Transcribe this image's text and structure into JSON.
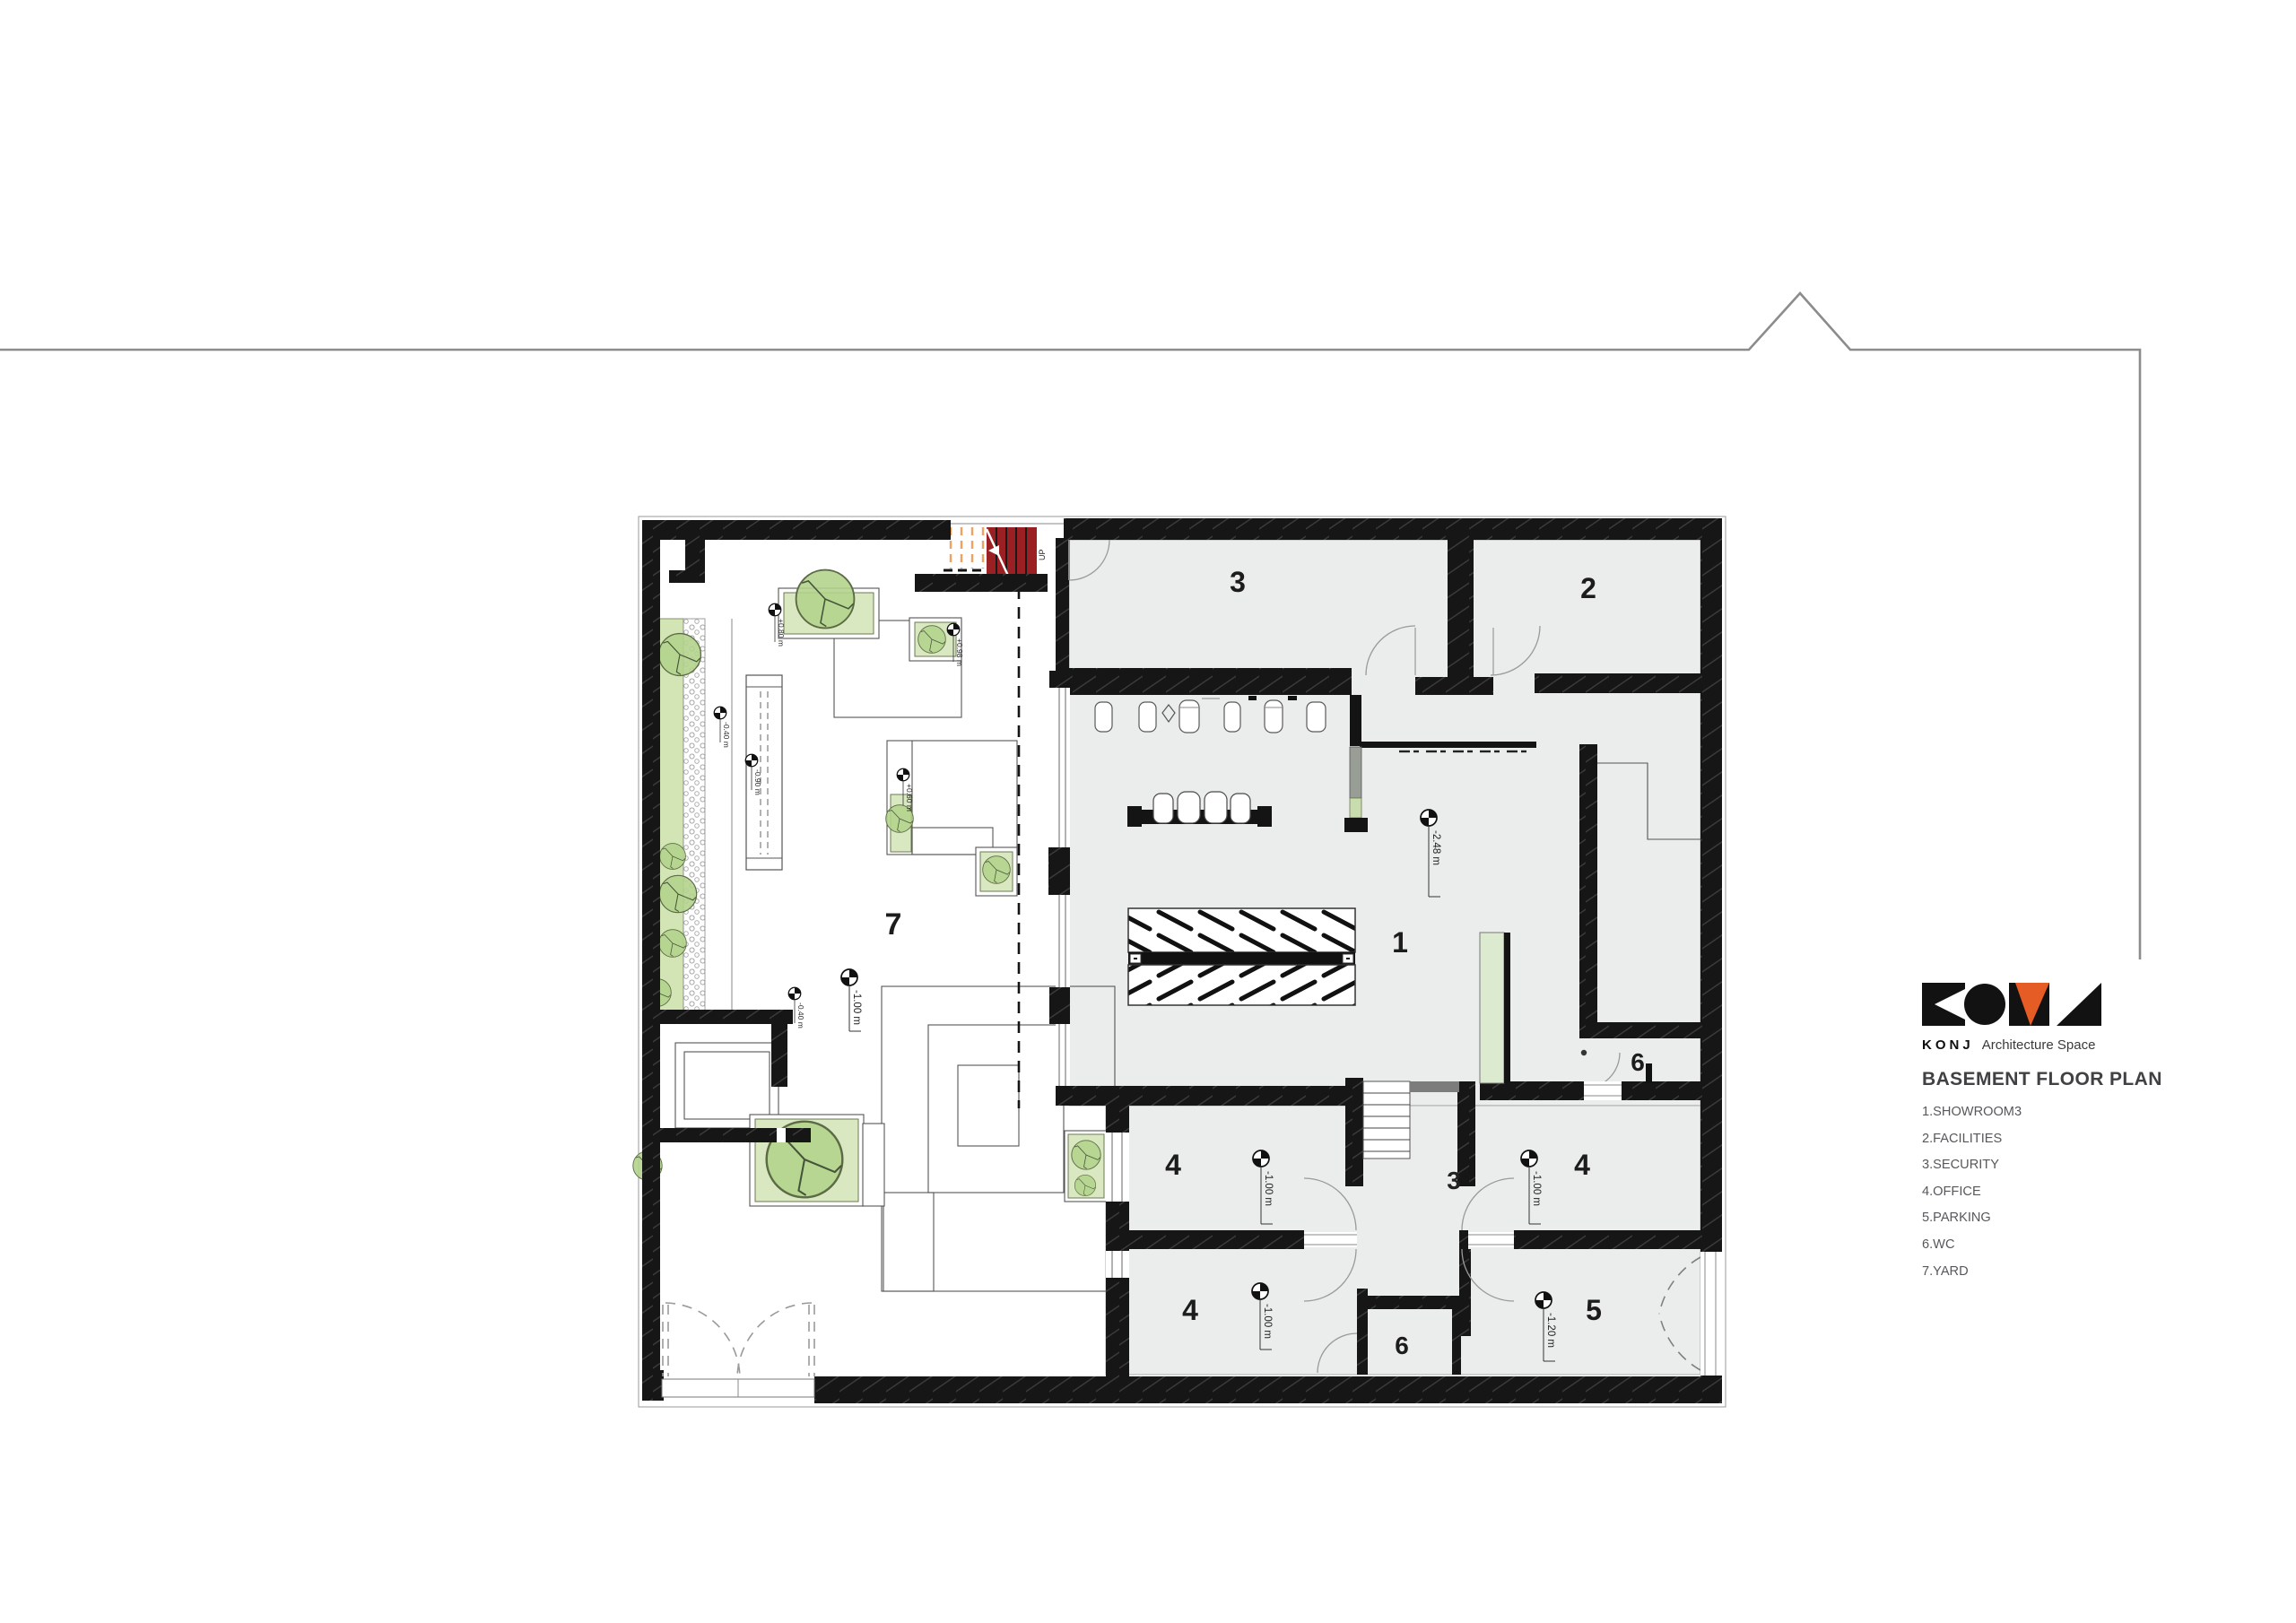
{
  "legend": {
    "brand_bold": "KONJ",
    "brand_rest": "Architecture Space",
    "title": "BASEMENT FLOOR PLAN",
    "items": [
      "1.SHOWROOM3",
      "2.FACILITIES",
      "3.SECURITY",
      "4.OFFICE",
      "5.PARKING",
      "6.WC",
      "7.YARD"
    ],
    "logo_colors": {
      "black": "#121212",
      "orange": "#e55c25"
    }
  },
  "plan": {
    "stair_up_label": "UP",
    "labels": [
      {
        "text": "3"
      },
      {
        "text": "2"
      },
      {
        "text": "1"
      },
      {
        "text": "4"
      },
      {
        "text": "4"
      },
      {
        "text": "4"
      },
      {
        "text": "5"
      },
      {
        "text": "6"
      },
      {
        "text": "6"
      },
      {
        "text": "7"
      },
      {
        "text": "3"
      }
    ],
    "elevation_markers": [
      {
        "value": "-2.48 m"
      },
      {
        "value": "-1.00 m"
      },
      {
        "value": "-1.00 m"
      },
      {
        "value": "-1.00 m"
      },
      {
        "value": "-1.20 m"
      },
      {
        "value": "-1.00 m"
      },
      {
        "value": "+0.80 m"
      },
      {
        "value": "+0.98 m"
      },
      {
        "value": "+0.60 m"
      },
      {
        "value": "-0.40 m"
      },
      {
        "value": "-0.90 m"
      },
      {
        "value": "-0.40 m"
      }
    ],
    "colors": {
      "wall": "#161616",
      "floor": "#ebecec",
      "stair_red": "#9b2024",
      "stair_orange_dash": "#eda262",
      "grass": "#d4e5b5",
      "planter_green": "#d9e8c1",
      "landing_gray": "#7c7c7c"
    }
  }
}
